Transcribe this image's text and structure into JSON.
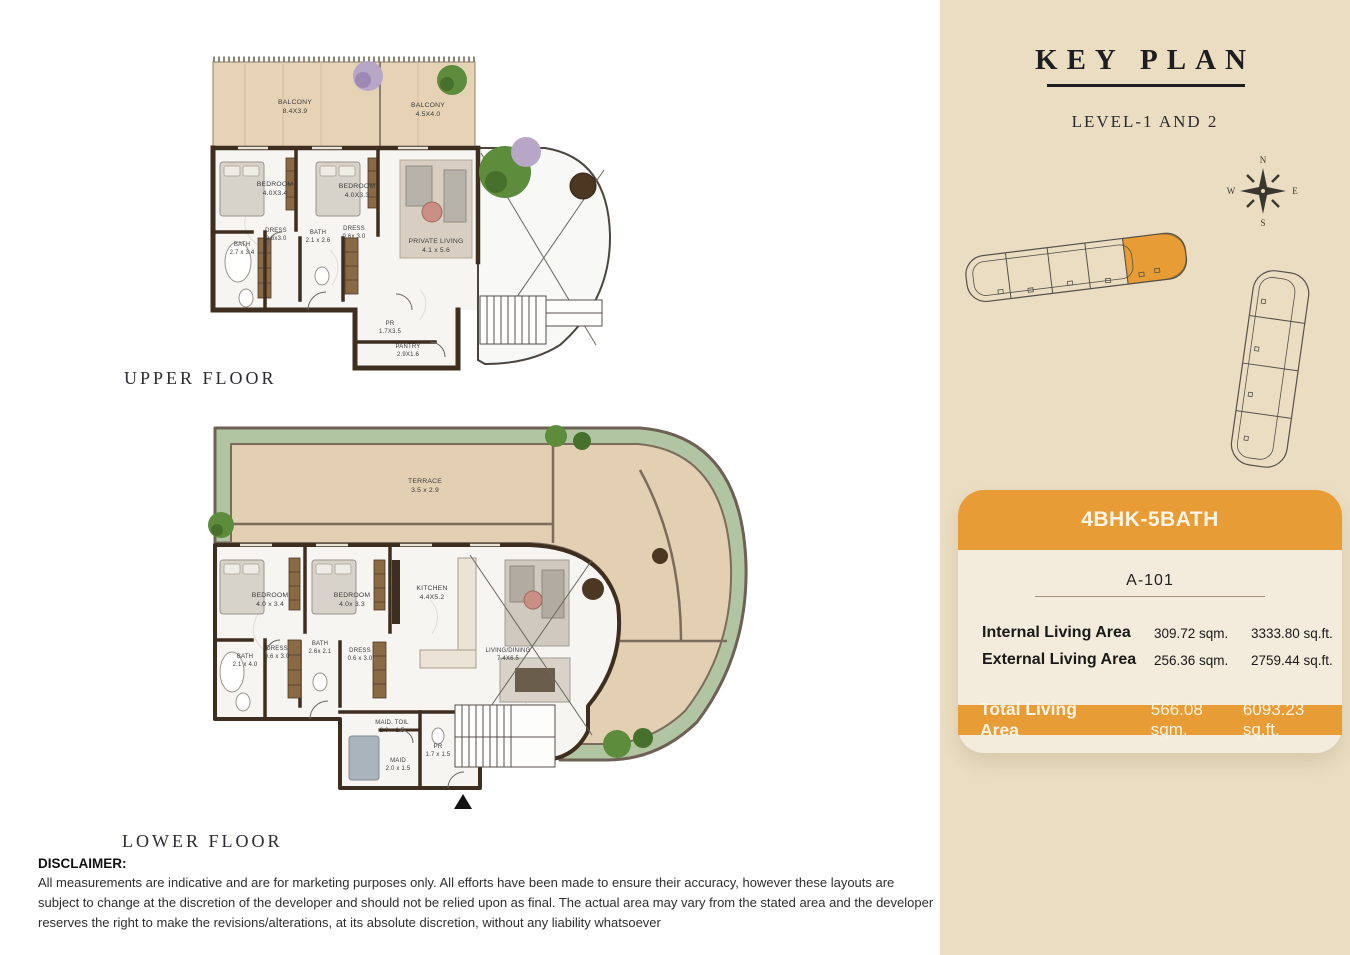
{
  "titles": {
    "upper_floor": "UPPER FLOOR",
    "lower_floor": "LOWER FLOOR"
  },
  "disclaimer": {
    "heading": "DISCLAIMER:",
    "body": "All measurements are indicative and are for marketing purposes only. All efforts have been made to ensure their accuracy, however these layouts are subject to change at the discretion of the developer and should not be relied upon as final. The actual area may vary from the stated area and the developer reserves the right to make the revisions/alterations, at its absolute discretion, without any liability whatsoever"
  },
  "sidebar": {
    "title": "KEY PLAN",
    "subtitle": "LEVEL-1 AND 2",
    "accent_color": "#e89c35",
    "background": "#eaddc2",
    "compass": {
      "n": "N",
      "e": "E",
      "s": "S",
      "w": "W"
    },
    "card": {
      "header": "4BHK-5BATH",
      "unit": "A-101",
      "rows": [
        {
          "label": "Internal Living Area",
          "sqm": "309.72 sqm.",
          "sqft": "3333.80 sq.ft."
        },
        {
          "label": "External Living Area",
          "sqm": "256.36 sqm.",
          "sqft": "2759.44 sq.ft."
        }
      ],
      "total": {
        "label": "Total Living Area",
        "sqm": "566.08 sqm.",
        "sqft": "6093.23 sq.ft."
      }
    }
  },
  "upper_floor": {
    "rooms": [
      {
        "name": "BALCONY",
        "dims": "8.4X3.9"
      },
      {
        "name": "BALCONY",
        "dims": "4.5X4.0"
      },
      {
        "name": "BEDROOM",
        "dims": "4.0X3.4"
      },
      {
        "name": "BEDROOM",
        "dims": "4.0X3.3"
      },
      {
        "name": "PRIVATE LIVING",
        "dims": "4.1 x 5.6"
      },
      {
        "name": "BATH",
        "dims": "2.7 x 3.4"
      },
      {
        "name": "DRESS",
        "dims": "0.6x3.0"
      },
      {
        "name": "BATH",
        "dims": "2.1 x 2.6"
      },
      {
        "name": "DRESS",
        "dims": "0.6x 3.0"
      },
      {
        "name": "PR",
        "dims": "1.7X3.5"
      },
      {
        "name": "PANTRY",
        "dims": "2.9X1.6"
      }
    ]
  },
  "lower_floor": {
    "rooms": [
      {
        "name": "TERRACE",
        "dims": "3.5 x 2.9"
      },
      {
        "name": "BEDROOM",
        "dims": "4.0 x 3.4"
      },
      {
        "name": "BEDROOM",
        "dims": "4.0x 3.3"
      },
      {
        "name": "KITCHEN",
        "dims": "4.4X5.2"
      },
      {
        "name": "LIVING/DINING",
        "dims": "7.4X6.5"
      },
      {
        "name": "BATH",
        "dims": "2.1 x 4.0"
      },
      {
        "name": "DRESS",
        "dims": "0.6 x 3.0"
      },
      {
        "name": "BATH",
        "dims": "2.6x 2.1"
      },
      {
        "name": "DRESS",
        "dims": "0.6 x 3.0"
      },
      {
        "name": "MAID. TOIL",
        "dims": "2.0 x 1.5"
      },
      {
        "name": "MAID",
        "dims": "2.0 x 1.5"
      },
      {
        "name": "PR",
        "dims": "1.7 x 1.5"
      }
    ]
  }
}
